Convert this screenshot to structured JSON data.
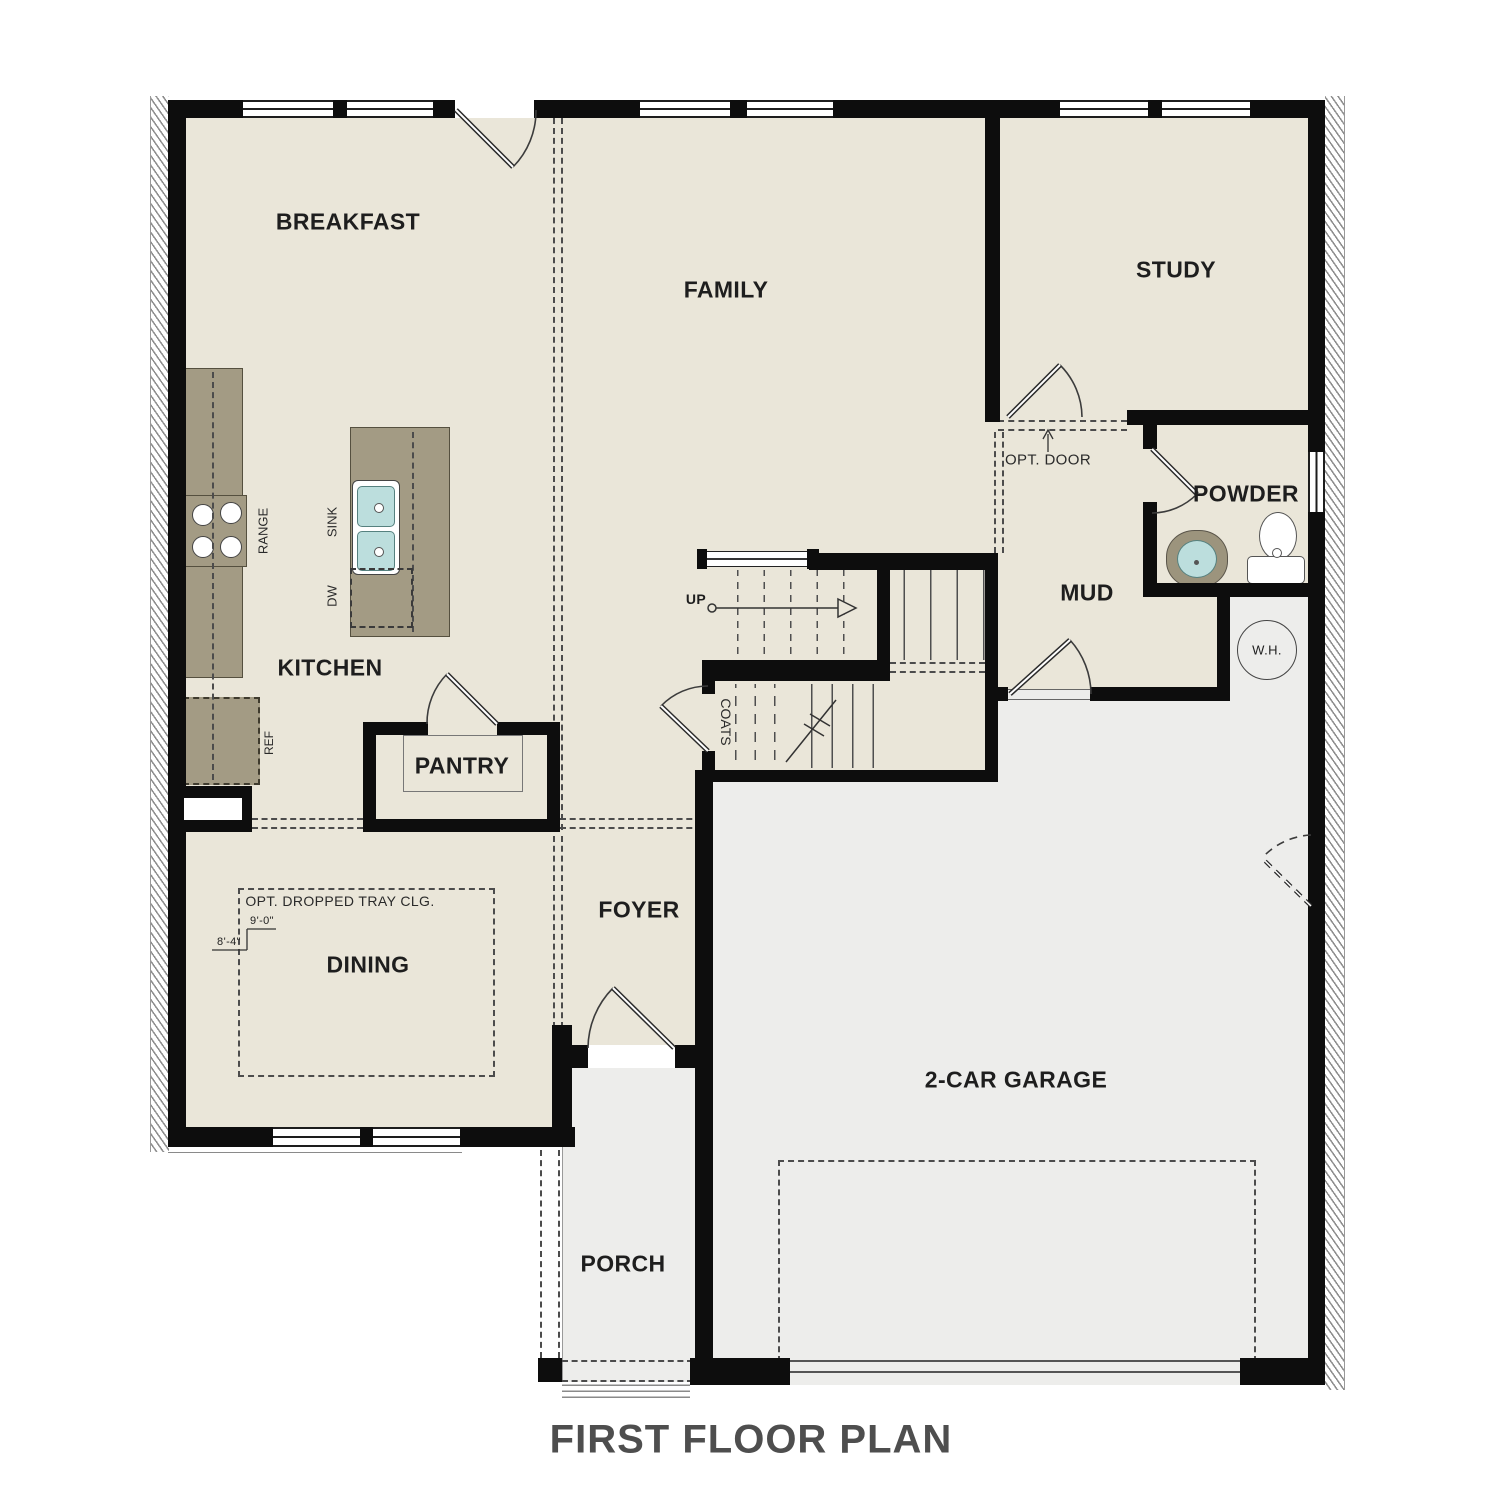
{
  "title": "FIRST FLOOR PLAN",
  "rooms": {
    "breakfast": "BREAKFAST",
    "family": "FAMILY",
    "study": "STUDY",
    "kitchen": "KITCHEN",
    "pantry": "PANTRY",
    "dining": "DINING",
    "foyer": "FOYER",
    "mud": "MUD",
    "powder": "POWDER",
    "garage": "2-CAR GARAGE",
    "porch": "PORCH"
  },
  "fixtures": {
    "range": "RANGE",
    "sink": "SINK",
    "dishwasher": "DW",
    "refrigerator": "REF",
    "coats": "COATS",
    "water_heater": "W.H.",
    "stairs_up": "UP"
  },
  "annotations": {
    "opt_door": "OPT. DOOR",
    "tray_ceiling": "OPT. DROPPED TRAY CLG.",
    "tray_height_a": "9'-0\"",
    "tray_height_b": "8'-4\""
  },
  "colors": {
    "floor_living": "#eae6d9",
    "floor_garage": "#ededeb",
    "wall": "#0d0d0d",
    "cabinet": "#a39b84",
    "sink_basin": "#bcdedd",
    "dash_line": "#4c4c4c",
    "title_text": "#4e4e4e"
  }
}
